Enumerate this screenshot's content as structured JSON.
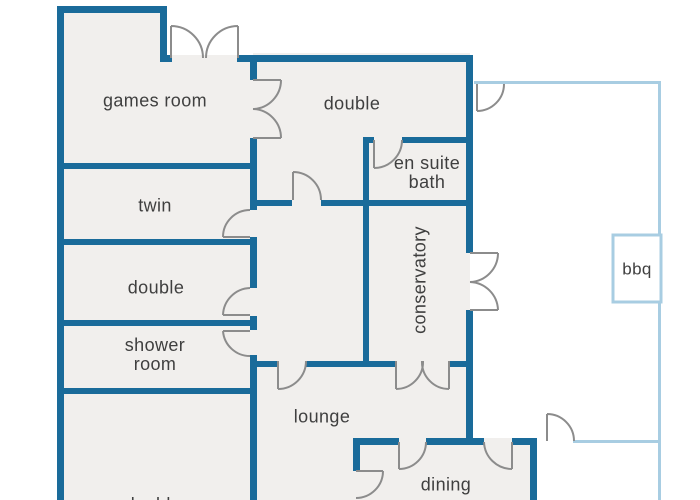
{
  "plan": {
    "type": "floor-plan",
    "rooms": [
      {
        "name": "games room"
      },
      {
        "name": "double"
      },
      {
        "name": "en suite\nbath"
      },
      {
        "name": "twin"
      },
      {
        "name": "conservatory",
        "orientation": "vertical"
      },
      {
        "name": "double"
      },
      {
        "name": "shower\nroom"
      },
      {
        "name": "lounge"
      },
      {
        "name": "dining"
      },
      {
        "name": "double",
        "note": "partially cut off at bottom edge"
      }
    ],
    "outdoor": {
      "bbq": "bbq"
    },
    "colors": {
      "wall": "#1a6b9a",
      "patio_outline": "#a8cde2",
      "floor_fill": "#f1efed",
      "door_arc": "#8c8c8c",
      "label_text": "#3f3f3f",
      "background": "#ffffff"
    }
  }
}
